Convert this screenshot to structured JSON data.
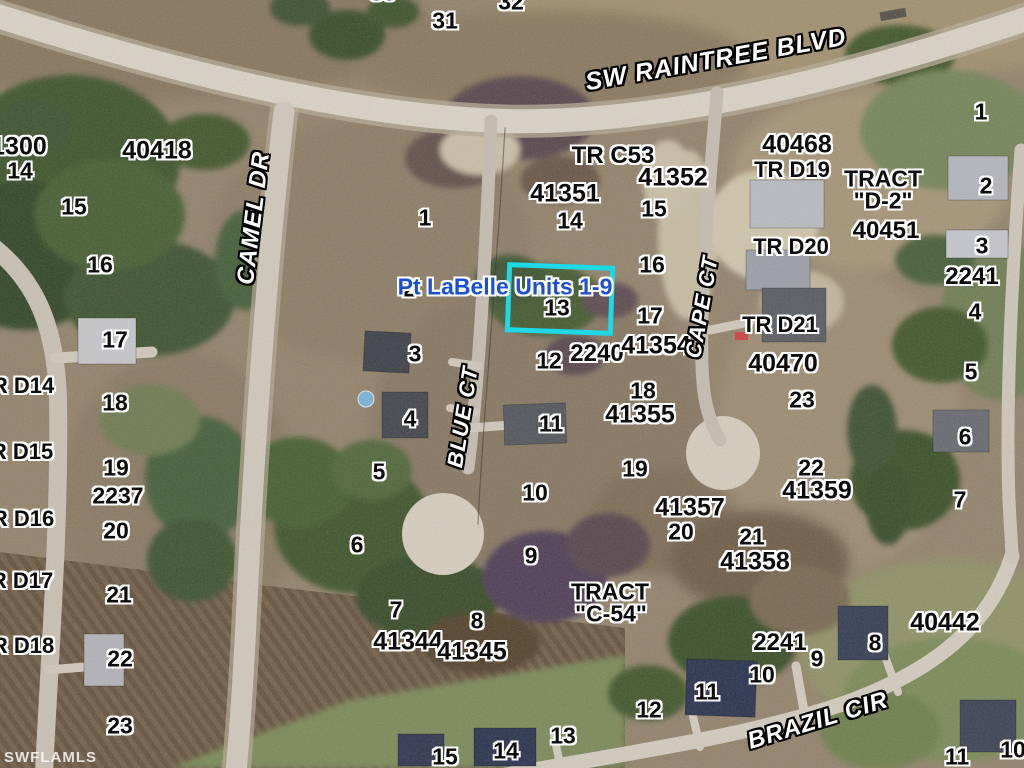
{
  "map": {
    "title_overlay": {
      "text": "Pt LaBelle Units 1-9",
      "color": "#1b4fd6",
      "x": 505,
      "y": 287
    },
    "highlight_box": {
      "color": "#1fd8e6",
      "x": 506,
      "y": 264,
      "width": 98,
      "height": 60,
      "rotation_deg": 2,
      "highlighted_lot": "13"
    },
    "watermark": {
      "text": "SWFLAMLS"
    },
    "roads": [
      {
        "name": "SW RAINTREE BLVD",
        "x": 716,
        "y": 60,
        "rot": -10,
        "size": 25
      },
      {
        "name": "CAMEL DR",
        "x": 254,
        "y": 218,
        "rot": -83,
        "size": 24
      },
      {
        "name": "BLUE CT",
        "x": 463,
        "y": 417,
        "rot": -81,
        "size": 22
      },
      {
        "name": "CAPE CT",
        "x": 702,
        "y": 307,
        "rot": -80,
        "size": 22
      },
      {
        "name": "BRAZIL CIR",
        "x": 818,
        "y": 721,
        "rot": -17,
        "size": 24
      }
    ],
    "parcel_labels": [
      {
        "text": "30",
        "x": 383,
        "y": -7
      },
      {
        "text": "31",
        "x": 445,
        "y": 21
      },
      {
        "text": "32",
        "x": 511,
        "y": 2
      },
      {
        "text": "41300",
        "x": 12,
        "y": 147,
        "size": 25
      },
      {
        "text": "14",
        "x": 20,
        "y": 171
      },
      {
        "text": "40418",
        "x": 157,
        "y": 151,
        "size": 25
      },
      {
        "text": "15",
        "x": 74,
        "y": 207
      },
      {
        "text": "16",
        "x": 100,
        "y": 265
      },
      {
        "text": "17",
        "x": 115,
        "y": 340
      },
      {
        "text": "R D14",
        "x": 23,
        "y": 386,
        "size": 22
      },
      {
        "text": "18",
        "x": 115,
        "y": 403
      },
      {
        "text": "R D15",
        "x": 22,
        "y": 452,
        "size": 22
      },
      {
        "text": "19",
        "x": 116,
        "y": 468
      },
      {
        "text": "2237",
        "x": 118,
        "y": 496
      },
      {
        "text": "R D16",
        "x": 23,
        "y": 519,
        "size": 22
      },
      {
        "text": "20",
        "x": 116,
        "y": 531
      },
      {
        "text": "R D17",
        "x": 22,
        "y": 581,
        "size": 22
      },
      {
        "text": "21",
        "x": 119,
        "y": 595
      },
      {
        "text": "R D18",
        "x": 23,
        "y": 646,
        "size": 22
      },
      {
        "text": "22",
        "x": 120,
        "y": 659
      },
      {
        "text": "23",
        "x": 120,
        "y": 726
      },
      {
        "text": "1",
        "x": 425,
        "y": 218
      },
      {
        "text": "2",
        "x": 409,
        "y": 289
      },
      {
        "text": "3",
        "x": 415,
        "y": 354
      },
      {
        "text": "4",
        "x": 410,
        "y": 419
      },
      {
        "text": "5",
        "x": 379,
        "y": 472
      },
      {
        "text": "6",
        "x": 357,
        "y": 545
      },
      {
        "text": "7",
        "x": 396,
        "y": 610
      },
      {
        "text": "8",
        "x": 477,
        "y": 621
      },
      {
        "text": "9",
        "x": 531,
        "y": 556
      },
      {
        "text": "10",
        "x": 535,
        "y": 493
      },
      {
        "text": "11",
        "x": 551,
        "y": 424
      },
      {
        "text": "12",
        "x": 549,
        "y": 361
      },
      {
        "text": "13",
        "x": 557,
        "y": 308
      },
      {
        "text": "14",
        "x": 570,
        "y": 221
      },
      {
        "text": "15",
        "x": 654,
        "y": 209
      },
      {
        "text": "16",
        "x": 652,
        "y": 265
      },
      {
        "text": "17",
        "x": 650,
        "y": 316
      },
      {
        "text": "18",
        "x": 643,
        "y": 391
      },
      {
        "text": "19",
        "x": 635,
        "y": 469
      },
      {
        "text": "TR C53",
        "x": 613,
        "y": 156,
        "size": 24
      },
      {
        "text": "41351",
        "x": 565,
        "y": 194,
        "size": 25
      },
      {
        "text": "41352",
        "x": 673,
        "y": 178,
        "size": 25
      },
      {
        "text": "2240",
        "x": 597,
        "y": 354,
        "size": 24
      },
      {
        "text": "41354",
        "x": 656,
        "y": 346,
        "size": 25
      },
      {
        "text": "41355",
        "x": 640,
        "y": 415,
        "size": 25
      },
      {
        "text": "41344",
        "x": 408,
        "y": 642,
        "size": 25
      },
      {
        "text": "41345",
        "x": 472,
        "y": 652,
        "size": 25
      },
      {
        "text": "TRACT",
        "x": 610,
        "y": 592,
        "size": 23
      },
      {
        "text": "\"C-54\"",
        "x": 611,
        "y": 614,
        "size": 23
      },
      {
        "text": "41357",
        "x": 690,
        "y": 508,
        "size": 25
      },
      {
        "text": "20",
        "x": 681,
        "y": 532
      },
      {
        "text": "21",
        "x": 752,
        "y": 537
      },
      {
        "text": "41358",
        "x": 755,
        "y": 562,
        "size": 25
      },
      {
        "text": "22",
        "x": 811,
        "y": 468
      },
      {
        "text": "41359",
        "x": 817,
        "y": 491,
        "size": 25
      },
      {
        "text": "23",
        "x": 802,
        "y": 400
      },
      {
        "text": "TR D21",
        "x": 780,
        "y": 325,
        "size": 22
      },
      {
        "text": "40470",
        "x": 783,
        "y": 364,
        "size": 25
      },
      {
        "text": "40468",
        "x": 797,
        "y": 145,
        "size": 25
      },
      {
        "text": "TR D19",
        "x": 792,
        "y": 170,
        "size": 22
      },
      {
        "text": "TR D20",
        "x": 791,
        "y": 247,
        "size": 22
      },
      {
        "text": "TRACT",
        "x": 883,
        "y": 179,
        "size": 23
      },
      {
        "text": "\"D-2\"",
        "x": 883,
        "y": 201,
        "size": 23
      },
      {
        "text": "40451",
        "x": 886,
        "y": 231,
        "size": 24
      },
      {
        "text": "1",
        "x": 981,
        "y": 112
      },
      {
        "text": "2",
        "x": 986,
        "y": 186
      },
      {
        "text": "3",
        "x": 982,
        "y": 246
      },
      {
        "text": "2241",
        "x": 972,
        "y": 277,
        "size": 24
      },
      {
        "text": "4",
        "x": 975,
        "y": 312
      },
      {
        "text": "5",
        "x": 971,
        "y": 372
      },
      {
        "text": "6",
        "x": 965,
        "y": 437
      },
      {
        "text": "7",
        "x": 960,
        "y": 500
      },
      {
        "text": "40442",
        "x": 945,
        "y": 623,
        "size": 25
      },
      {
        "text": "2241",
        "x": 780,
        "y": 643,
        "size": 24
      },
      {
        "text": "8",
        "x": 875,
        "y": 643
      },
      {
        "text": "9",
        "x": 817,
        "y": 659
      },
      {
        "text": "10",
        "x": 762,
        "y": 675
      },
      {
        "text": "11",
        "x": 707,
        "y": 692
      },
      {
        "text": "12",
        "x": 649,
        "y": 710
      },
      {
        "text": "13",
        "x": 563,
        "y": 736
      },
      {
        "text": "14",
        "x": 506,
        "y": 751
      },
      {
        "text": "15",
        "x": 445,
        "y": 757
      },
      {
        "text": "11",
        "x": 957,
        "y": 757
      },
      {
        "text": "10",
        "x": 1013,
        "y": 750
      }
    ]
  }
}
